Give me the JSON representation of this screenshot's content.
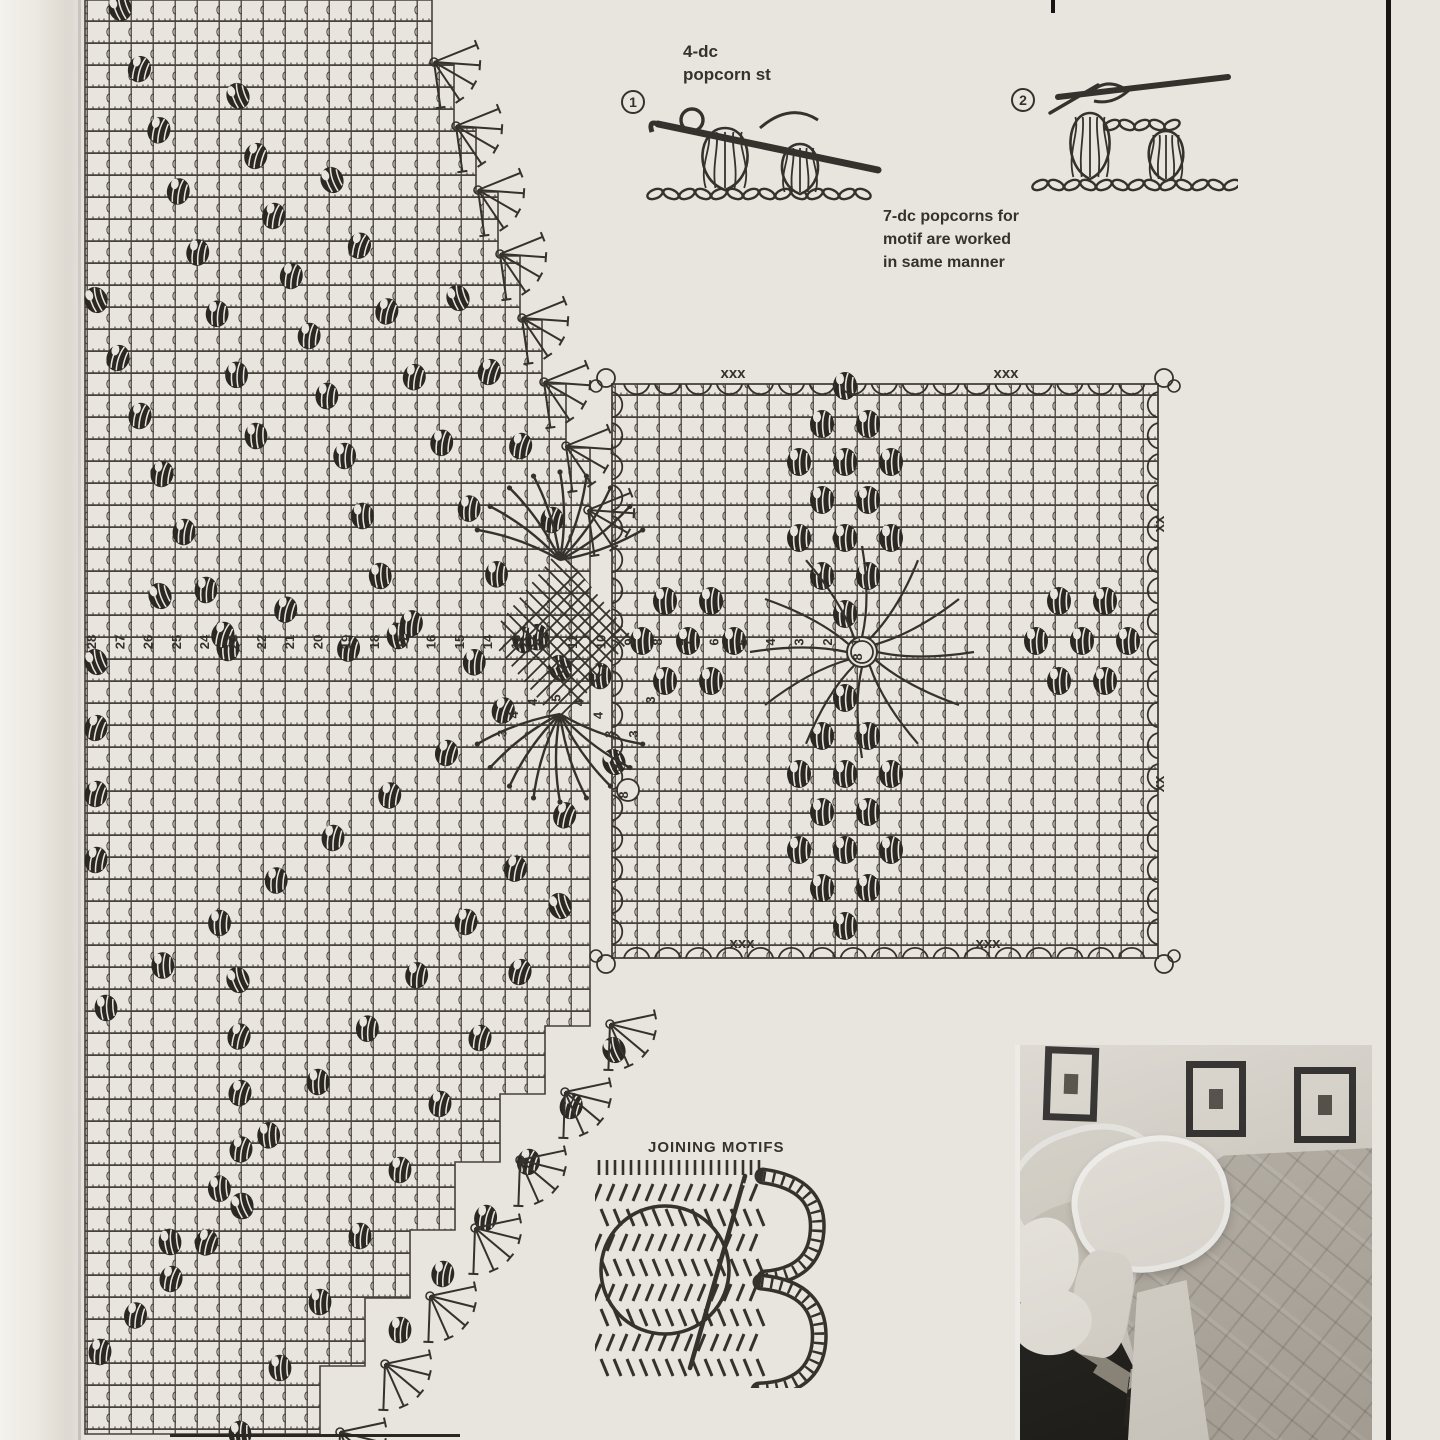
{
  "page": {
    "paper_color": "#e8e5df",
    "ink_color": "#35322d"
  },
  "stitch_guide": {
    "step1": {
      "number": "1",
      "label": "4-dc\npopcorn st"
    },
    "step2": {
      "number": "2"
    },
    "note": "7-dc popcorns for\nmotif are worked\nin same manner"
  },
  "joining_section": {
    "title": "JOINING MOTIFS"
  },
  "chart": {
    "row_numbers": [
      "28",
      "27",
      "26",
      "25",
      "24",
      "23",
      "22",
      "21",
      "20",
      "19",
      "18",
      "17",
      "16",
      "15",
      "14",
      "13",
      "12",
      "11",
      "10",
      "9",
      "8",
      "7",
      "6",
      "5",
      "4",
      "3",
      "2",
      "1"
    ],
    "fan_stitch_counts": [
      "3",
      "4",
      "4",
      "5",
      "4",
      "4",
      "3"
    ],
    "spoke_counts": [
      "3",
      "3",
      "3"
    ],
    "motif_center_label": "8",
    "fan_base_label": "8",
    "corner_picot_marks": "xxx",
    "edge_picot_marks": "xx"
  }
}
